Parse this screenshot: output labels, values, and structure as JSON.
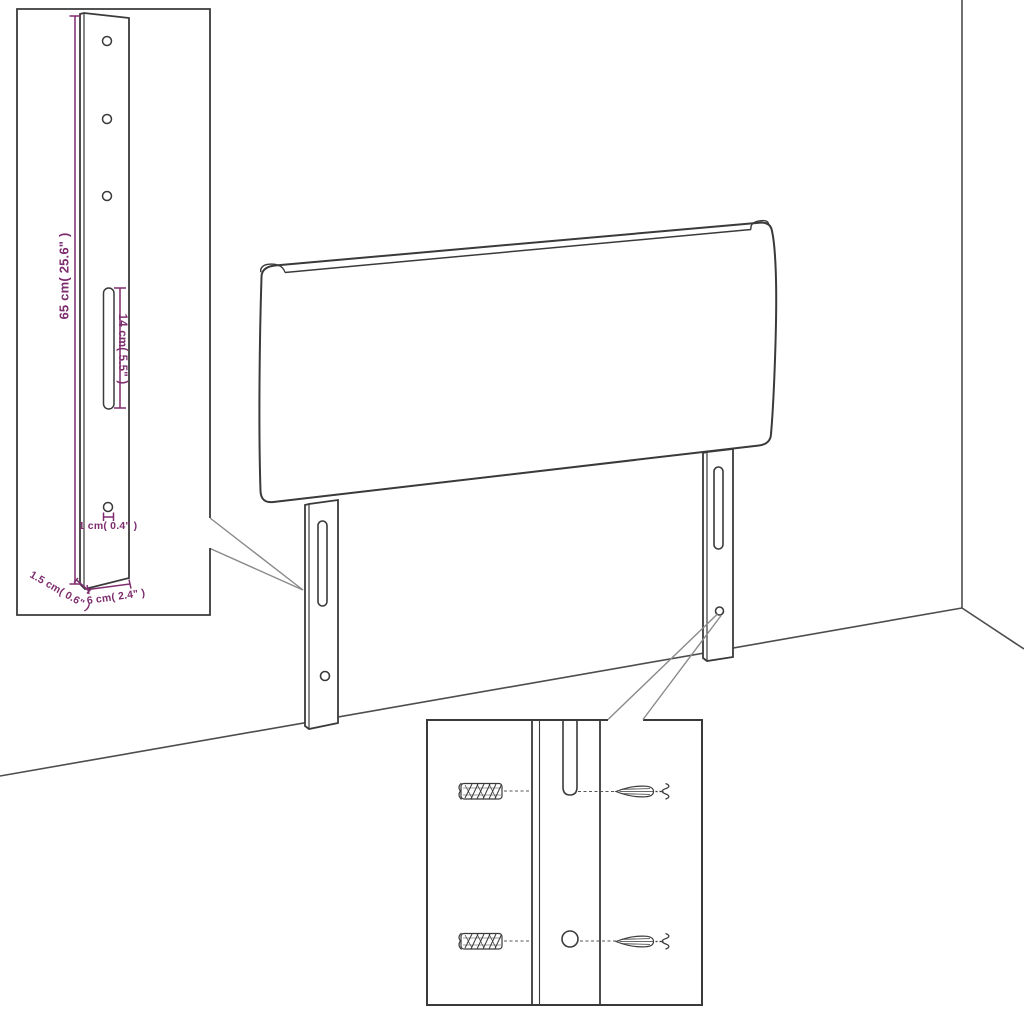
{
  "page": {
    "background": "#ffffff",
    "description": "Line-art dimension diagram of a headboard with two wall-mount legs standing in a room corner, with a leg-dimension callout and a wall-plug/screw mounting callout"
  },
  "colors": {
    "outline": "#3a3a3a",
    "dimension": "#7d2c6e",
    "leader_line": "#8a8a8a",
    "wall_line": "#4d4d4d"
  },
  "labels": {
    "leg_height": "65 cm( 25.6\" )",
    "slot_length": "14 cm( 5.5\" )",
    "hole_diameter": "1 cm( 0.4\" )",
    "leg_thickness": "1.5 cm( 0.6\" )",
    "leg_width": "6 cm( 2.4\" )"
  },
  "callouts": {
    "leg_detail": {
      "upper_holes": 3,
      "lower_holes": 1,
      "slots": 1
    },
    "mounting_detail": {
      "wall_plugs": 2,
      "screws": 2
    }
  }
}
